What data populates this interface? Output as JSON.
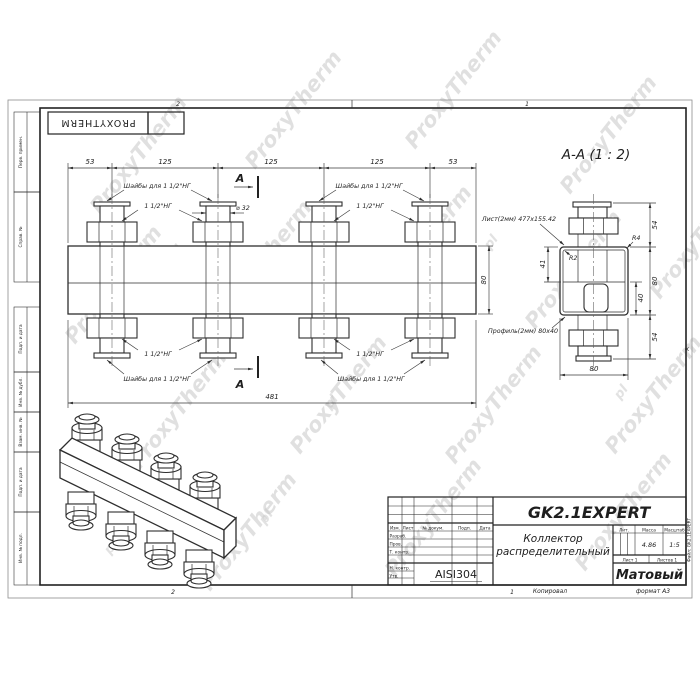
{
  "watermark": {
    "text": "ProxyTherm",
    "suffix": "pl"
  },
  "stamp_brand": "PROXYTHERM",
  "frame": {
    "zone_top_left": "2",
    "zone_top_right": "1",
    "zone_bottom_left": "2",
    "zone_bottom_right": "1",
    "zone_right": "А",
    "copied": "Копировал",
    "format": "формат А3",
    "side_note": "Файл: GK2.1EXPERT",
    "margin_labels": [
      "Перв. примен.",
      "Справ. №",
      "Подп. и дата",
      "Инв. № дубл.",
      "Взам. инв. №",
      "Подп. и дата",
      "Инв. № подл."
    ]
  },
  "front_view": {
    "dim_53_left": "53",
    "dim_125_1": "125",
    "dim_125_2": "125",
    "dim_125_3": "125",
    "dim_53_right": "53",
    "dim_total": "481",
    "dim_height": "80",
    "dim_dia": "⌀ 32",
    "label_washers": "Шайбы для 1 1/2\"НГ",
    "label_thread": "1 1/2\"НГ",
    "section_letter": "A"
  },
  "section_view": {
    "title": "A-A (1 : 2)",
    "dim_54_top": "54",
    "dim_80_right": "80",
    "dim_40": "40",
    "dim_54_bottom": "54",
    "dim_41": "41",
    "dim_80_bottom": "80",
    "radius_outer": "R4",
    "radius_inner": "R2",
    "label_sheet": "Лист(2мм) 477x155.42",
    "label_profile": "Профиль(2мм) 80x40"
  },
  "title_block": {
    "code": "GK2.1EXPERT",
    "name_line1": "Коллектор",
    "name_line2": "распределительный",
    "material": "AISI304",
    "finish": "Матовый",
    "lit": "Лит.",
    "mass_label": "Масса",
    "scale_label": "Масштаб",
    "mass": "4.86",
    "scale": "1:5",
    "sheet": "Лист 1",
    "sheets": "Листов 1",
    "col_izm": "Изм.",
    "col_list": "Лист",
    "col_doc": "№ докум.",
    "col_sign": "Подп.",
    "col_date": "Дата",
    "row_razrab": "Разраб.",
    "row_prov": "Пров.",
    "row_tkontr": "Т. контр.",
    "row_nkontr": "Н. контр.",
    "row_utv": "Утв."
  }
}
